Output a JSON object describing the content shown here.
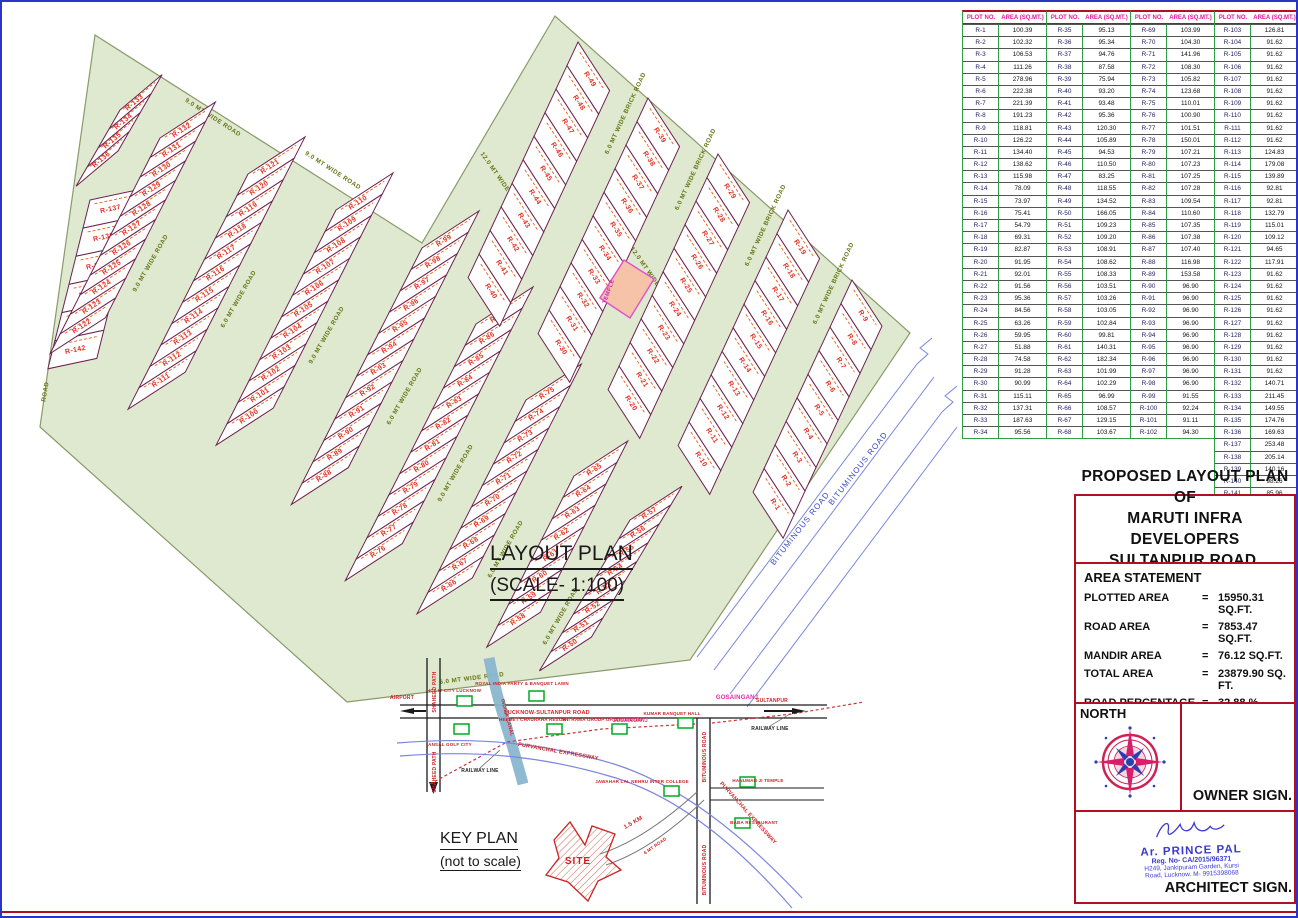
{
  "sheet": {
    "layout_title": "LAYOUT PLAN",
    "layout_scale": "(SCALE- 1:100)",
    "key_plan_title": "KEY PLAN",
    "key_plan_subtitle": "(not to scale)"
  },
  "plot_table": {
    "headers": [
      "PLOT NO.",
      "AREA (SQ.MT.)"
    ],
    "columns": [
      [
        [
          "R-1",
          "100.39"
        ],
        [
          "R-2",
          "102.32"
        ],
        [
          "R-3",
          "106.53"
        ],
        [
          "R-4",
          "111.26"
        ],
        [
          "R-5",
          "278.96"
        ],
        [
          "R-6",
          "222.38"
        ],
        [
          "R-7",
          "221.39"
        ],
        [
          "R-8",
          "191.23"
        ],
        [
          "R-9",
          "118.81"
        ],
        [
          "R-10",
          "126.22"
        ],
        [
          "R-11",
          "134.40"
        ],
        [
          "R-12",
          "138.62"
        ],
        [
          "R-13",
          "115.98"
        ],
        [
          "R-14",
          "78.09"
        ],
        [
          "R-15",
          "73.97"
        ],
        [
          "R-16",
          "75.41"
        ],
        [
          "R-17",
          "54.79"
        ],
        [
          "R-18",
          "69.31"
        ],
        [
          "R-19",
          "82.87"
        ],
        [
          "R-20",
          "91.95"
        ],
        [
          "R-21",
          "92.01"
        ],
        [
          "R-22",
          "91.56"
        ],
        [
          "R-23",
          "95.36"
        ],
        [
          "R-24",
          "84.56"
        ],
        [
          "R-25",
          "63.26"
        ],
        [
          "R-26",
          "59.95"
        ],
        [
          "R-27",
          "51.88"
        ],
        [
          "R-28",
          "74.58"
        ],
        [
          "R-29",
          "91.28"
        ],
        [
          "R-30",
          "90.99"
        ],
        [
          "R-31",
          "115.11"
        ],
        [
          "R-32",
          "137.31"
        ],
        [
          "R-33",
          "187.63"
        ],
        [
          "R-34",
          "95.56"
        ]
      ],
      [
        [
          "R-35",
          "95.13"
        ],
        [
          "R-36",
          "95.34"
        ],
        [
          "R-37",
          "94.76"
        ],
        [
          "R-38",
          "87.58"
        ],
        [
          "R-39",
          "75.94"
        ],
        [
          "R-40",
          "93.20"
        ],
        [
          "R-41",
          "93.48"
        ],
        [
          "R-42",
          "95.36"
        ],
        [
          "R-43",
          "120.30"
        ],
        [
          "R-44",
          "105.89"
        ],
        [
          "R-45",
          "94.53"
        ],
        [
          "R-46",
          "110.50"
        ],
        [
          "R-47",
          "83.25"
        ],
        [
          "R-48",
          "118.55"
        ],
        [
          "R-49",
          "134.52"
        ],
        [
          "R-50",
          "166.05"
        ],
        [
          "R-51",
          "109.23"
        ],
        [
          "R-52",
          "109.20"
        ],
        [
          "R-53",
          "108.91"
        ],
        [
          "R-54",
          "108.62"
        ],
        [
          "R-55",
          "108.33"
        ],
        [
          "R-56",
          "103.51"
        ],
        [
          "R-57",
          "103.26"
        ],
        [
          "R-58",
          "103.05"
        ],
        [
          "R-59",
          "102.84"
        ],
        [
          "R-60",
          "99.81"
        ],
        [
          "R-61",
          "140.31"
        ],
        [
          "R-62",
          "182.34"
        ],
        [
          "R-63",
          "101.99"
        ],
        [
          "R-64",
          "102.29"
        ],
        [
          "R-65",
          "96.99"
        ],
        [
          "R-66",
          "108.57"
        ],
        [
          "R-67",
          "129.15"
        ],
        [
          "R-68",
          "103.67"
        ]
      ],
      [
        [
          "R-69",
          "103.99"
        ],
        [
          "R-70",
          "104.30"
        ],
        [
          "R-71",
          "141.96"
        ],
        [
          "R-72",
          "108.30"
        ],
        [
          "R-73",
          "105.82"
        ],
        [
          "R-74",
          "123.68"
        ],
        [
          "R-75",
          "110.01"
        ],
        [
          "R-76",
          "100.90"
        ],
        [
          "R-77",
          "101.51"
        ],
        [
          "R-78",
          "150.01"
        ],
        [
          "R-79",
          "107.21"
        ],
        [
          "R-80",
          "107.23"
        ],
        [
          "R-81",
          "107.25"
        ],
        [
          "R-82",
          "107.28"
        ],
        [
          "R-83",
          "109.54"
        ],
        [
          "R-84",
          "110.60"
        ],
        [
          "R-85",
          "107.35"
        ],
        [
          "R-86",
          "107.38"
        ],
        [
          "R-87",
          "107.40"
        ],
        [
          "R-88",
          "116.98"
        ],
        [
          "R-89",
          "153.58"
        ],
        [
          "R-90",
          "96.90"
        ],
        [
          "R-91",
          "96.90"
        ],
        [
          "R-92",
          "96.90"
        ],
        [
          "R-93",
          "96.90"
        ],
        [
          "R-94",
          "96.90"
        ],
        [
          "R-95",
          "96.90"
        ],
        [
          "R-96",
          "96.90"
        ],
        [
          "R-97",
          "96.90"
        ],
        [
          "R-98",
          "96.90"
        ],
        [
          "R-99",
          "91.55"
        ],
        [
          "R-100",
          "92.24"
        ],
        [
          "R-101",
          "91.11"
        ],
        [
          "R-102",
          "94.30"
        ]
      ],
      [
        [
          "R-103",
          "126.81"
        ],
        [
          "R-104",
          "91.62"
        ],
        [
          "R-105",
          "91.62"
        ],
        [
          "R-106",
          "91.62"
        ],
        [
          "R-107",
          "91.62"
        ],
        [
          "R-108",
          "91.62"
        ],
        [
          "R-109",
          "91.62"
        ],
        [
          "R-110",
          "91.62"
        ],
        [
          "R-111",
          "91.62"
        ],
        [
          "R-112",
          "91.62"
        ],
        [
          "R-113",
          "124.83"
        ],
        [
          "R-114",
          "179.08"
        ],
        [
          "R-115",
          "139.89"
        ],
        [
          "R-116",
          "92.81"
        ],
        [
          "R-117",
          "92.81"
        ],
        [
          "R-118",
          "132.79"
        ],
        [
          "R-119",
          "115.01"
        ],
        [
          "R-120",
          "109.12"
        ],
        [
          "R-121",
          "94.65"
        ],
        [
          "R-122",
          "117.91"
        ],
        [
          "R-123",
          "91.62"
        ],
        [
          "R-124",
          "91.62"
        ],
        [
          "R-125",
          "91.62"
        ],
        [
          "R-126",
          "91.62"
        ],
        [
          "R-127",
          "91.62"
        ],
        [
          "R-128",
          "91.62"
        ],
        [
          "R-129",
          "91.62"
        ],
        [
          "R-130",
          "91.62"
        ],
        [
          "R-131",
          "91.62"
        ],
        [
          "R-132",
          "140.71"
        ],
        [
          "R-133",
          "211.45"
        ],
        [
          "R-134",
          "149.55"
        ],
        [
          "R-135",
          "174.76"
        ],
        [
          "R-136",
          "169.63"
        ],
        [
          "R-137",
          "253.48"
        ],
        [
          "R-138",
          "205.14"
        ],
        [
          "R-139",
          "140.16"
        ],
        [
          "R-140",
          "98.26"
        ],
        [
          "R-141",
          "85.96"
        ],
        [
          "R-142",
          "167.24"
        ]
      ]
    ]
  },
  "title_block": {
    "line1": "PROPOSED LAYOUT PLAN OF",
    "line2": "MARUTI INFRA DEVELOPERS",
    "line3": "SULTANPUR ROAD, LUCKNOW"
  },
  "area_statement": {
    "title": "AREA STATEMENT",
    "equals": "=",
    "rows": [
      {
        "label": "PLOTTED AREA",
        "value": "15950.31 SQ.FT."
      },
      {
        "label": "ROAD AREA",
        "value": "7853.47 SQ.FT."
      },
      {
        "label": "MANDIR AREA",
        "value": "76.12 SQ.FT."
      },
      {
        "label": "TOTAL AREA",
        "value": "23879.90 SQ. FT."
      },
      {
        "label": "ROAD PERCENTAGE",
        "value": "32.88 %"
      },
      {
        "label": "PLOT PERCENTAGE",
        "value": "67.11 %"
      }
    ]
  },
  "north": {
    "label": "NORTH"
  },
  "signs": {
    "owner": "OWNER SIGN.",
    "architect": "ARCHITECT SIGN."
  },
  "stamp": {
    "name": "Ar. PRINCE PAL",
    "reg": "Reg. No- CA/2015/96371",
    "addr1": "H249, Jankipuram Garden, Kursi",
    "addr2": "Road, Lucknow.  M- 9915398068"
  },
  "plan": {
    "colors": {
      "site_fill": "#dfe9cf",
      "site_stroke": "#8a9a6a",
      "plot_stroke": "#6d2250",
      "label_red": "#e03123",
      "road_text": "#667515",
      "bitumen_blue": "#3b49c4",
      "temple_fill": "#f6c3a8",
      "temple_stroke": "#dd55cc"
    },
    "temple_label": "TEMPLE",
    "bituminous_label": "BITUMINOUS ROAD",
    "strips": [
      {
        "s": [
          88,
          198
        ],
        "stack": 104,
        "depth": -12,
        "t": 29,
        "d": 50,
        "from": 137,
        "to": 142,
        "rev": false
      },
      {
        "s": [
          118,
          108
        ],
        "stack": 120,
        "depth": -40,
        "t": 22,
        "d": 55,
        "from": 133,
        "to": 136,
        "rev": false
      },
      {
        "s": [
          158,
          136
        ],
        "stack": 117,
        "depth": -33,
        "t": 22,
        "d": 66,
        "from": 122,
        "to": 132,
        "rev": true
      },
      {
        "s": [
          246,
          172
        ],
        "stack": 117,
        "depth": -33,
        "t": 24,
        "d": 68,
        "from": 111,
        "to": 121,
        "rev": true
      },
      {
        "s": [
          334,
          208
        ],
        "stack": 117,
        "depth": -33,
        "t": 24,
        "d": 68,
        "from": 100,
        "to": 110,
        "rev": true
      },
      {
        "s": [
          420,
          246
        ],
        "stack": 117,
        "depth": -33,
        "t": 24,
        "d": 68,
        "from": 88,
        "to": 99,
        "rev": true
      },
      {
        "s": [
          474,
          322
        ],
        "stack": 117,
        "depth": -33,
        "t": 24,
        "d": 68,
        "from": 76,
        "to": 87,
        "rev": true
      },
      {
        "s": [
          524,
          398
        ],
        "stack": 117,
        "depth": -33,
        "t": 24,
        "d": 66,
        "from": 66,
        "to": 75,
        "rev": true
      },
      {
        "s": [
          572,
          474
        ],
        "stack": 117,
        "depth": -33,
        "t": 24,
        "d": 64,
        "from": 58,
        "to": 65,
        "rev": true
      },
      {
        "s": [
          628,
          518
        ],
        "stack": 121,
        "depth": -33,
        "t": 22,
        "d": 62,
        "from": 50,
        "to": 57,
        "rev": true
      },
      {
        "s": [
          576,
          40
        ],
        "stack": 115,
        "depth": 57,
        "t": 26,
        "d": 58,
        "from": 40,
        "to": 49,
        "rev": true
      },
      {
        "s": [
          646,
          96
        ],
        "stack": 115,
        "depth": 57,
        "t": 26,
        "d": 58,
        "from": 30,
        "to": 39,
        "rev": true
      },
      {
        "s": [
          716,
          152
        ],
        "stack": 115,
        "depth": 57,
        "t": 26,
        "d": 58,
        "from": 20,
        "to": 29,
        "rev": true
      },
      {
        "s": [
          786,
          208
        ],
        "stack": 115,
        "depth": 57,
        "t": 26,
        "d": 58,
        "from": 10,
        "to": 19,
        "rev": true
      },
      {
        "s": [
          850,
          278
        ],
        "stack": 115,
        "depth": 57,
        "t": 26,
        "d": 55,
        "from": 1,
        "to": 9,
        "rev": true
      }
    ],
    "road_labels": [
      {
        "t": "9.0 MT WIDE ROAD",
        "x": 210,
        "y": 117,
        "r": 33
      },
      {
        "t": "9.0 MT WIDE ROAD",
        "x": 330,
        "y": 170,
        "r": 33
      },
      {
        "t": "9.0 MT WIDE ROAD",
        "x": 70,
        "y": 290,
        "r": -75
      },
      {
        "t": "ROAD",
        "x": 45,
        "y": 390,
        "r": -80
      },
      {
        "t": "9.0 MT WIDE ROAD",
        "x": 150,
        "y": 262,
        "r": -60
      },
      {
        "t": "6.0 MT WIDE ROAD",
        "x": 238,
        "y": 298,
        "r": -60
      },
      {
        "t": "9.0 MT WIDE ROAD",
        "x": 326,
        "y": 334,
        "r": -60
      },
      {
        "t": "6.0 MT WIDE ROAD",
        "x": 404,
        "y": 395,
        "r": -60
      },
      {
        "t": "9.0 MT WIDE ROAD",
        "x": 455,
        "y": 472,
        "r": -60
      },
      {
        "t": "6.0 MT WIDE ROAD",
        "x": 505,
        "y": 548,
        "r": -60
      },
      {
        "t": "6.0 MT WIDE ROAD",
        "x": 560,
        "y": 615,
        "r": -60
      },
      {
        "t": "6.0 MT WIDE ROAD",
        "x": 470,
        "y": 678,
        "r": -7
      },
      {
        "t": "6.0 MT WIDE BRICK ROAD",
        "x": 625,
        "y": 112,
        "r": -65
      },
      {
        "t": "6.0 MT WIDE BRICK ROAD",
        "x": 695,
        "y": 168,
        "r": -65
      },
      {
        "t": "6.0 MT WIDE BRICK ROAD",
        "x": 765,
        "y": 224,
        "r": -65
      },
      {
        "t": "6.0 MT WIDE BRICK ROAD",
        "x": 833,
        "y": 282,
        "r": -65
      },
      {
        "t": "12.0 MT WIDE BRICK ROAD",
        "x": 655,
        "y": 285,
        "r": 55
      },
      {
        "t": "12.0 MT WIDE BRICK ROAD",
        "x": 505,
        "y": 190,
        "r": 55
      }
    ]
  },
  "key_plan": {
    "site_label": "SITE",
    "labels": [
      {
        "t": "GOSAINGANJ",
        "x": 735,
        "y": 697,
        "r": 0,
        "c": "#ee22aa",
        "s": 6
      },
      {
        "t": "GOSAINGANJ",
        "x": 628,
        "y": 720,
        "r": 0,
        "c": "#ee22aa",
        "s": 5
      },
      {
        "t": "LUCKNOW-SULTANPUR ROAD",
        "x": 545,
        "y": 712,
        "r": 0,
        "c": "#cc2222",
        "s": 5.5
      },
      {
        "t": "SULTANPUR",
        "x": 770,
        "y": 700,
        "r": 0,
        "c": "#cc2222",
        "s": 5
      },
      {
        "t": "AIRPORT",
        "x": 400,
        "y": 697,
        "r": 0,
        "c": "#cc2222",
        "s": 5
      },
      {
        "t": "SHAHEED PATH",
        "x": 434,
        "y": 690,
        "r": -90,
        "c": "#cc2222",
        "s": 5
      },
      {
        "t": "SHAHEED PATH",
        "x": 434,
        "y": 770,
        "r": -90,
        "c": "#cc2222",
        "s": 5
      },
      {
        "t": "INDIRA CANAL",
        "x": 504,
        "y": 716,
        "r": 75,
        "c": "#cc2222",
        "s": 5
      },
      {
        "t": "RAILWAY LINE",
        "x": 478,
        "y": 770,
        "r": 0,
        "c": "#222222",
        "s": 5
      },
      {
        "t": "RAILWAY LINE",
        "x": 768,
        "y": 728,
        "r": 0,
        "c": "#222222",
        "s": 5
      },
      {
        "t": "PURVANCHAL EXPRESSWAY",
        "x": 556,
        "y": 751,
        "r": 10,
        "c": "#cc2222",
        "s": 5.5
      },
      {
        "t": "PURVANCHAL EXPRESSWAY",
        "x": 745,
        "y": 812,
        "r": 48,
        "c": "#cc2222",
        "s": 5.5
      },
      {
        "t": "BITUMINOUS ROAD",
        "x": 704,
        "y": 755,
        "r": -90,
        "c": "#cc2222",
        "s": 5
      },
      {
        "t": "BITUMINOUS ROAD",
        "x": 704,
        "y": 868,
        "r": -90,
        "c": "#cc2222",
        "s": 5
      },
      {
        "t": "1.5 KM",
        "x": 632,
        "y": 822,
        "r": -30,
        "c": "#cc2222",
        "s": 6
      },
      {
        "t": "6 MT ROAD",
        "x": 654,
        "y": 845,
        "r": -35,
        "c": "#cc2222",
        "s": 4.5
      },
      {
        "t": "HCL IT CITY LUCKNOW",
        "x": 452,
        "y": 690,
        "r": 0,
        "c": "#cc2222",
        "s": 4.5
      },
      {
        "t": "ROYAL INDIA PARTY & BANQUET LAWN",
        "x": 520,
        "y": 683,
        "r": 0,
        "c": "#cc2222",
        "s": 4.5
      },
      {
        "t": "ANSAL GOLF CITY",
        "x": 448,
        "y": 744,
        "r": 0,
        "c": "#cc2222",
        "s": 4.5
      },
      {
        "t": "HELMET CHAURAHA RESORT",
        "x": 532,
        "y": 719,
        "r": 0,
        "c": "#cc2222",
        "s": 4.5
      },
      {
        "t": "SRI RAMA GROUP OF INSTITUTES",
        "x": 600,
        "y": 719,
        "r": 0,
        "c": "#cc2222",
        "s": 4.5
      },
      {
        "t": "KUMAR BANQUET HALL",
        "x": 670,
        "y": 713,
        "r": 0,
        "c": "#cc2222",
        "s": 4.5
      },
      {
        "t": "JAWAHAR LAL NEHRU INTER COLLEGE",
        "x": 640,
        "y": 781,
        "r": 0,
        "c": "#cc2222",
        "s": 4.5
      },
      {
        "t": "HANUMAN JI TEMPLE",
        "x": 756,
        "y": 780,
        "r": 0,
        "c": "#cc2222",
        "s": 4.5
      },
      {
        "t": "BABA RESTAURANT",
        "x": 752,
        "y": 822,
        "r": 0,
        "c": "#cc2222",
        "s": 4.5
      }
    ],
    "boxes": [
      [
        455,
        694
      ],
      [
        527,
        689
      ],
      [
        452,
        722
      ],
      [
        545,
        722
      ],
      [
        610,
        722
      ],
      [
        676,
        716
      ],
      [
        662,
        784
      ],
      [
        738,
        775
      ],
      [
        733,
        816
      ]
    ]
  }
}
